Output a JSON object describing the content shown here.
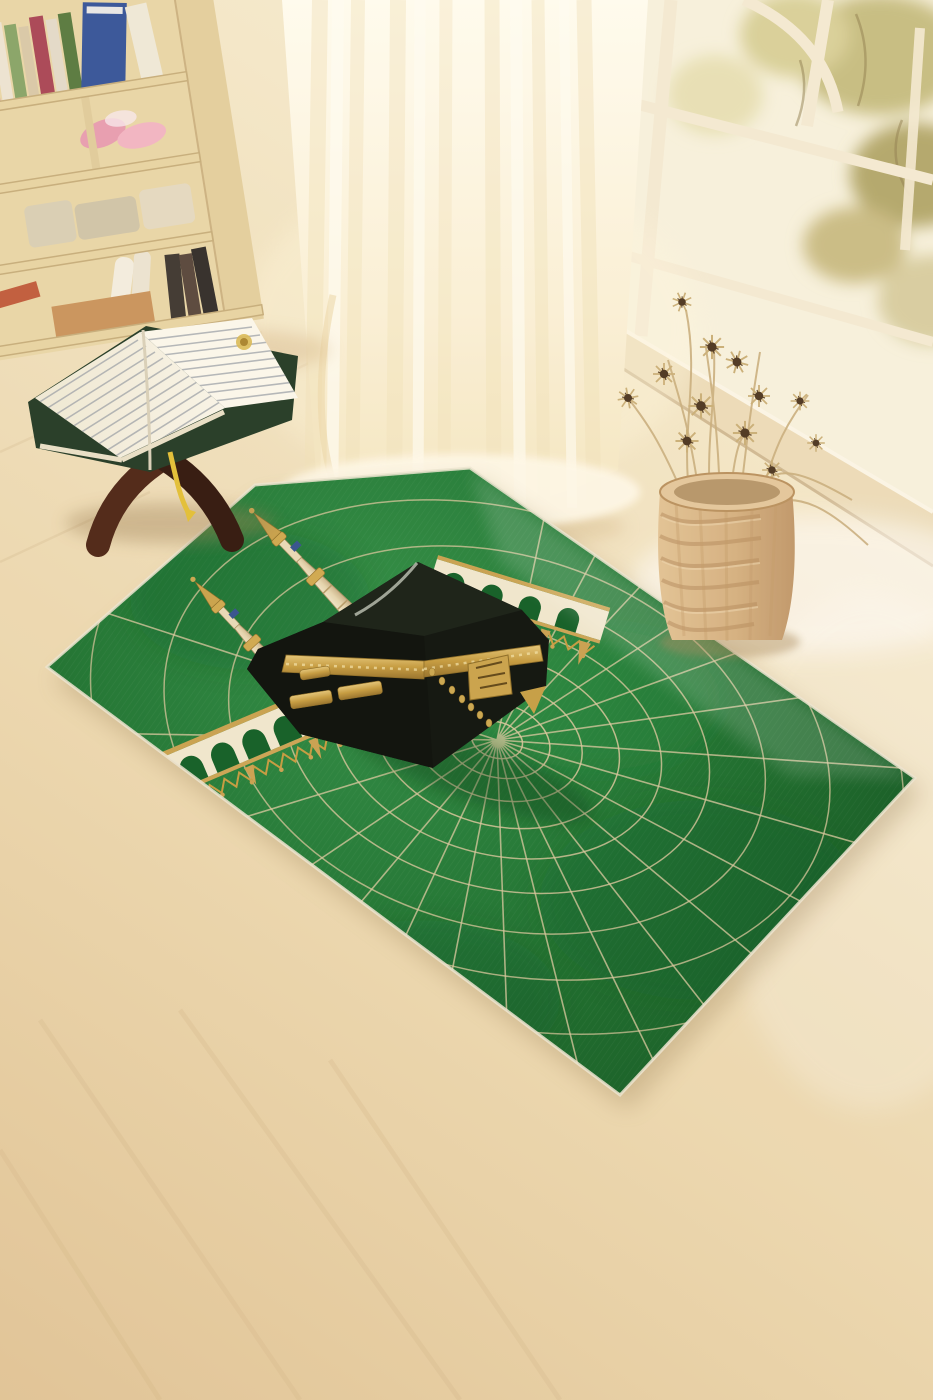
{
  "scene": {
    "type": "product-photograph",
    "subject": "Kaaba-themed green prayer rug displayed on a light wooden floor",
    "objects": [
      "cream bookshelf with colorful books and pink slippers",
      "open Quran resting on a dark wooden rehal stand with yellow ribbon bookmark",
      "sheer cream curtain pooling on the floor",
      "white paned window with arch muntin and blurred garden foliage",
      "wicker basket holding dried beige flowers with dark seed heads",
      "green prayer rug with Kaaba cube, twin minarets, arched colonnade and radiating gold web"
    ]
  },
  "rug": {
    "motifs": [
      "Kaaba black cube with gold hizam calligraphy band and ornate gold door",
      "two cream-and-gold minarets pointing to the upper-left",
      "white arched colonnade with gold rails and hanging gold fringe",
      "web of gold spokes and concentric rings radiating from the Kaaba",
      "cream edge binding around the rug"
    ],
    "web_spokes": 21,
    "web_rings": 11
  },
  "colors": {
    "kaaba_black": "#0a0f0b",
    "rug_green": "#1b7a33",
    "rug_green_dark": "#0d5420",
    "rug_green_light": "#2f9a4a",
    "web_gold": "#dccaa2",
    "web_gold_soft": "#d8c59c",
    "gold": "#c9a24a",
    "gold_dark": "#8a6a24",
    "arcade_cream": "#f0e7cf",
    "glass_pale": "#f7f2df",
    "sill_cream": "#ecdcba",
    "window_frame": "#f4ead4",
    "curtain_cream": "#fbf3dc",
    "floor_tan": "#ead8b2",
    "basket_tan": "#d6b384",
    "basket_rim": "#e3c79c",
    "stand_brown": "#4b2315",
    "stand_brown_dark": "#2f150c",
    "page_white": "#f6f2e4",
    "cover_green": "#203824",
    "ribbon_yellow": "#e2bf36",
    "foliage_olive": "#c6bd82",
    "flower_center": "#4a3420",
    "stem_beige": "#c8ad7e"
  }
}
